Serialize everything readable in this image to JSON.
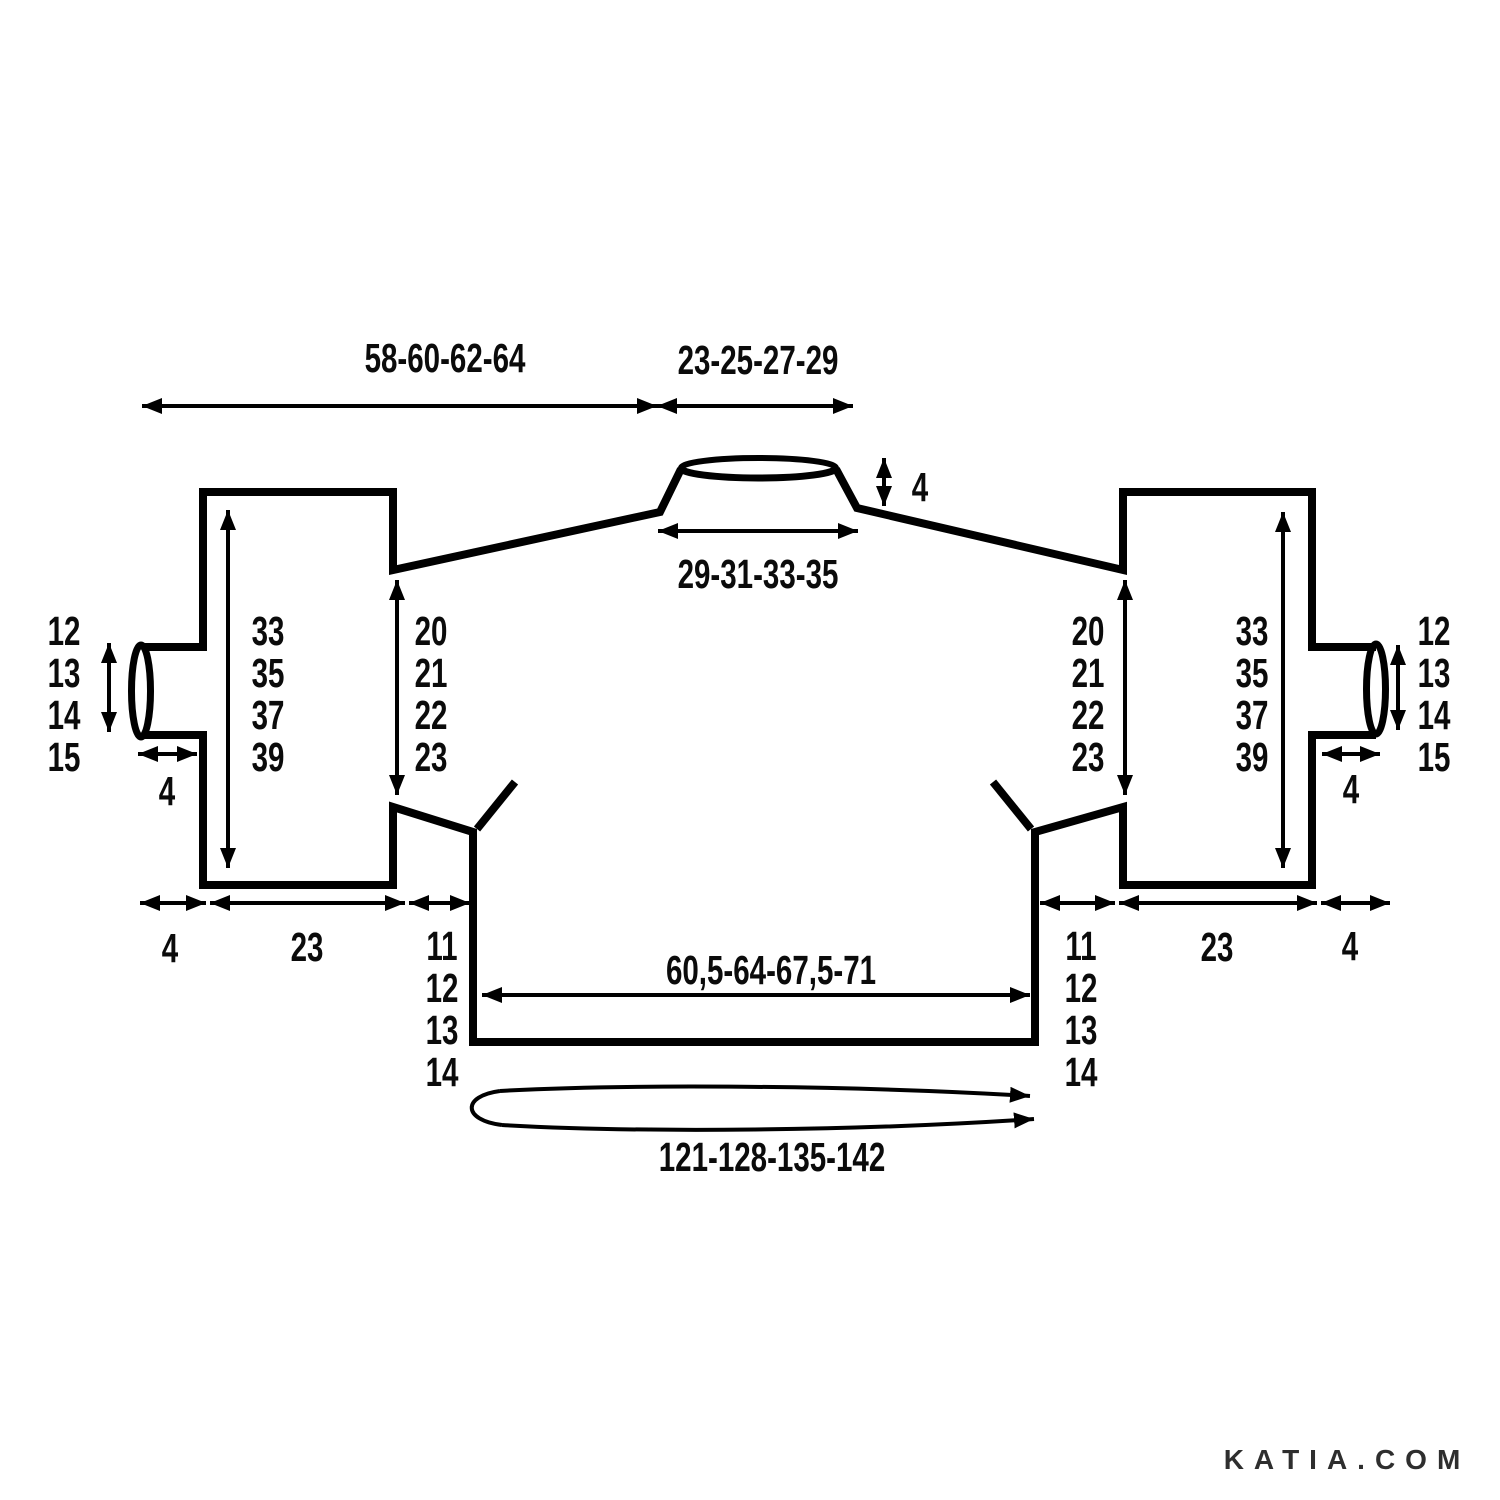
{
  "diagram": {
    "description": "Sweater knitting pattern measurement schematic (flat layout, 4 sizes, cm)",
    "watermark": "KATIA.COM",
    "colors": {
      "line": "#000000",
      "text": "#0b0b0b",
      "watermark": "#2e2e2e"
    },
    "labels": {
      "top_width_left": "58-60-62-64",
      "top_width_right": "23-25-27-29",
      "collar_height": "4",
      "neck_width": "29-31-33-35",
      "body_width": "60,5-64-67,5-71",
      "body_circumference": "121-128-135-142",
      "left_sleeve": {
        "cuff_opening": [
          "12",
          "13",
          "14",
          "15"
        ],
        "cuff_band_width": "4",
        "sleeve_length": [
          "33",
          "35",
          "37",
          "39"
        ],
        "armhole_depth": [
          "20",
          "21",
          "22",
          "23"
        ],
        "cuff_width_bottom": "4",
        "sleeve_width_bottom": "23",
        "side_length": [
          "11",
          "12",
          "13",
          "14"
        ]
      },
      "right_sleeve": {
        "cuff_opening": [
          "12",
          "13",
          "14",
          "15"
        ],
        "cuff_band_width": "4",
        "sleeve_length": [
          "33",
          "35",
          "37",
          "39"
        ],
        "armhole_depth": [
          "20",
          "21",
          "22",
          "23"
        ],
        "cuff_width_bottom": "4",
        "sleeve_width_bottom": "23",
        "side_length": [
          "11",
          "12",
          "13",
          "14"
        ]
      }
    }
  }
}
